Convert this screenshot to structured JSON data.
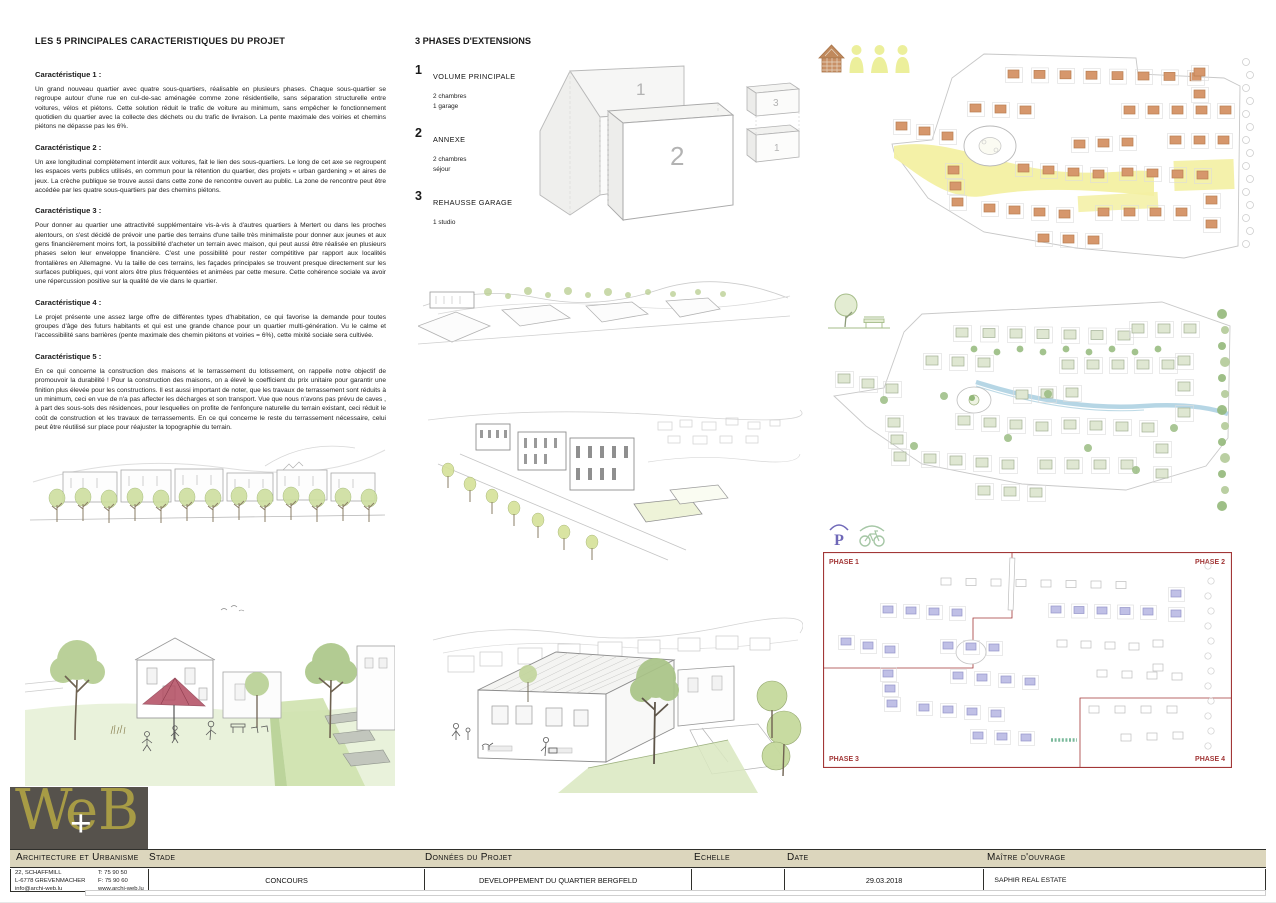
{
  "left": {
    "title": "LES 5 PRINCIPALES CARACTERISTIQUES DU PROJET",
    "characteristics": [
      {
        "heading": "Caractéristique 1 :",
        "body": "Un grand nouveau quartier avec quatre sous-quartiers, réalisable en plusieurs phases. Chaque sous-quartier se regroupe autour d'une rue en cul-de-sac aménagée comme zone résidentielle, sans séparation structurelle entre voitures, vélos et piétons. Cette solution réduit le trafic de voiture au minimum, sans empêcher le fonctionnement quotidien du quartier avec la collecte des déchets ou du trafic de livraison. La pente maximale des voiries et chemins piétons ne dépasse pas les 6%."
      },
      {
        "heading": "Caractéristique 2 :",
        "body": "Un axe longitudinal complètement interdit aux voitures, fait le lien des sous-quartiers. Le long de cet axe se regroupent les espaces verts publics utilisés, en commun pour la rétention du quartier, des projets « urban gardening » et aires de jeux. La crèche publique se trouve aussi dans cette zone de rencontre ouvert au public. La zone de rencontre peut être accédée par les quatre sous-quartiers par des chemins piétons."
      },
      {
        "heading": "Caractéristique 3 :",
        "body": "Pour donner au quartier une attractivité supplémentaire vis-à-vis à d'autres quartiers à Mertert ou dans les proches alentours, on s'est décidé de prévoir une partie des terrains d'une taille très minimaliste pour donner aux jeunes et aux gens financièrement moins fort, la possibilité d'acheter un terrain avec maison, qui peut aussi être réalisée en plusieurs phases selon leur enveloppe financière. C'est une possibilité pour rester compétitive par rapport aux localités frontalières en Allemagne. Vu la taille de ces terrains, les façades principales se trouvent presque directement sur les surfaces publiques, qui vont alors être plus fréquentées et animées par cette mesure. Cette cohérence sociale va avoir une répercussion positive sur la qualité de vie dans le quartier."
      },
      {
        "heading": "Caractéristique 4 :",
        "body": "Le projet présente une assez large offre de différentes types d'habitation, ce qui favorise la demande pour toutes groupes d'âge des futurs habitants et qui est une grande chance pour un quartier multi-génération. Vu le calme et l'accessibilité sans barrières (pente maximale des chemin piétons et voiries = 6%), cette mixité sociale sera cultivée."
      },
      {
        "heading": "Caractéristique 5 :",
        "body": "En ce qui concerne la construction des maisons et le terrassement du lotissement, on rappelle notre objectif de promouvoir la durabilité ! Pour la construction des maisons, on a élevé le coefficient du prix unitaire pour garantir une finition plus élevée pour les constructions. Il est aussi important de noter, que les travaux de terrassement sont réduits à un minimum, ceci en vue de n'a pas affecter les décharges et son transport. Vue que nous n'avons pas prévu de caves , à part des sous-sols des résidences, pour lesquelles on profite de l'enfonçure naturelle du terrain existant, ceci réduit le coût de construction et les travaux de terrassements. En ce qui concerne le reste du terrassement nécessaire, celui peut être réutilisé sur place pour réajuster la topographie du terrain."
      }
    ]
  },
  "phases": {
    "title": "3 PHASES D'EXTENSIONS",
    "items": [
      {
        "num": "1",
        "label": "VOLUME PRINCIPALE",
        "details": "2 chambres\n1 garage"
      },
      {
        "num": "2",
        "label": "ANNEXE",
        "details": "2 chambres\nséjour"
      },
      {
        "num": "3",
        "label": "REHAUSSE GARAGE",
        "details": "1 studio"
      }
    ],
    "diagram": {
      "back": "1",
      "front": "2",
      "garage_top": "3",
      "garage_base": "1"
    }
  },
  "plans": {
    "phase_labels": [
      "PHASE 1",
      "PHASE 2",
      "PHASE 3",
      "PHASE 4"
    ]
  },
  "icons": {
    "top_row": [
      "house-icon",
      "person-icon",
      "person-icon",
      "person-icon"
    ],
    "plan_green": "tree-bench-icon",
    "plan_phases": [
      "parking-icon",
      "bicycle-icon"
    ]
  },
  "palette": {
    "plan1_building": "#d6976c",
    "plan1_building_stroke": "#b97e52",
    "plan1_axis": "#f3f0a2",
    "plan2_block": "#dfe7d2",
    "plan2_block_stroke": "#a2af94",
    "plan2_tree": "#93b87a",
    "plan2_tree_alt": "#b2ca98",
    "plan2_stream": "#a9cfe0",
    "phase_red": "#a23737",
    "phase_building": "#c0c0e6",
    "phase_building_stroke": "#9595c8",
    "logo_bg": "#56524c",
    "logo_gold": "#a79b45",
    "footer_beige": "#dcd6bd",
    "icon_yellow": "#ecef9b",
    "icon_house_brown": "#c0895c",
    "icon_parking_purple": "#6f68b8",
    "icon_bike_green": "#a6c7a6",
    "canopy_red": "#b24b60"
  },
  "footer": {
    "logo": {
      "part1": "We",
      "plus": "+",
      "part2": "B"
    },
    "company": {
      "label": "Architecture et Urbanisme",
      "address_lines": "22, SCHAFFMILL\nL-6778 GREVENMACHER\ninfo@archi-web.lu",
      "contact_lines": "T: 75 90 50\nF: 75 90 60\nwww.archi-web.lu"
    },
    "stade": {
      "label": "Stade",
      "value": "CONCOURS"
    },
    "donnees": {
      "label": "Données du Projet",
      "value": "DEVELOPPEMENT DU QUARTIER BERGFELD"
    },
    "echelle": {
      "label": "Echelle",
      "value": ""
    },
    "date": {
      "label": "Date",
      "value": "29.03.2018"
    },
    "maitre": {
      "label": "Maître d'ouvrage",
      "value": "SAPHIR REAL ESTATE"
    }
  }
}
